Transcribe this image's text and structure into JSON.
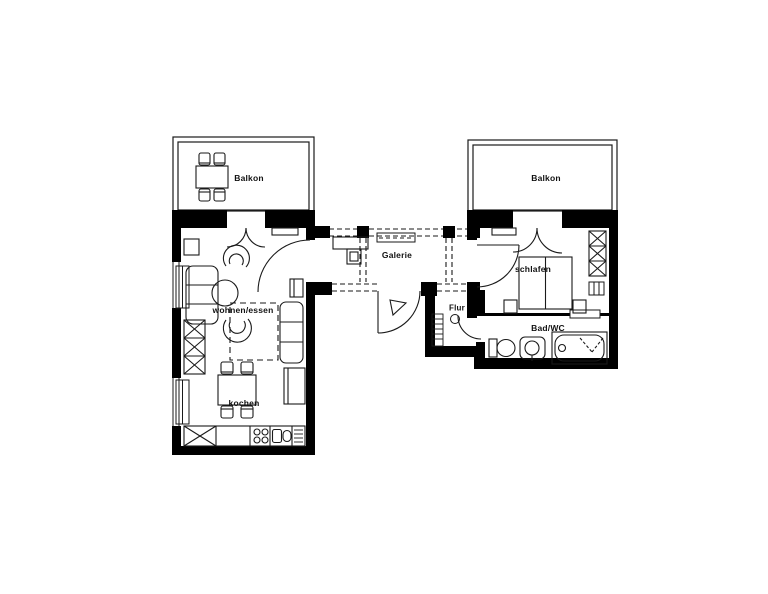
{
  "plan": {
    "type": "apartment-floor-plan",
    "colors": {
      "wall": "#000000",
      "line": "#1a1a1a",
      "background": "#ffffff"
    }
  },
  "rooms": [
    {
      "id": "balkon-left",
      "label": "Balkon"
    },
    {
      "id": "balkon-right",
      "label": "Balkon"
    },
    {
      "id": "galerie",
      "label": "Galerie"
    },
    {
      "id": "schlafen",
      "label": "schlafen"
    },
    {
      "id": "flur",
      "label": "Flur"
    },
    {
      "id": "bad-wc",
      "label": "Bad/WC"
    },
    {
      "id": "wohnen-essen",
      "label": "wohnen/essen"
    },
    {
      "id": "kochen",
      "label": "kochen"
    }
  ]
}
